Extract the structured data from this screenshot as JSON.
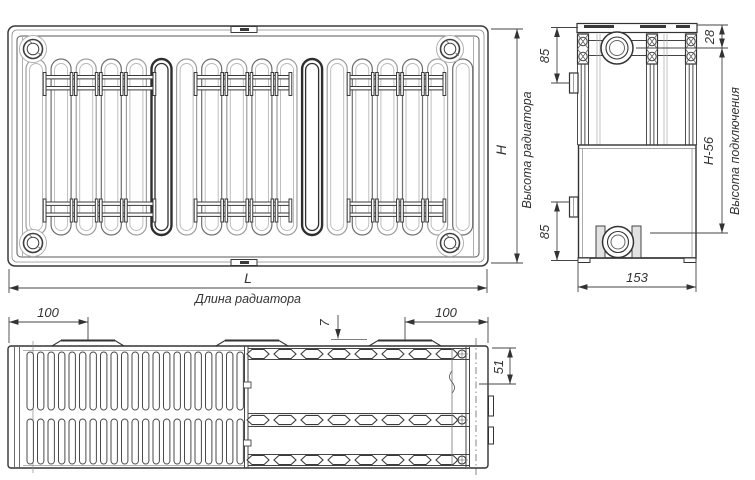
{
  "front_view": {
    "height_symbol": "H",
    "height_caption": "Высота радиатора",
    "length_symbol": "L",
    "length_caption": "Длина радиатора"
  },
  "side_view": {
    "top_bracket_offset": "85",
    "bottom_bracket_offset": "85",
    "top_edge_to_axis": "28",
    "connection_span": "H-56",
    "connection_caption": "Высота подключения",
    "depth": "153"
  },
  "top_view": {
    "left_bracket_offset": "100",
    "right_bracket_offset": "100",
    "grille_step": "7",
    "panel_depth": "51"
  },
  "colors": {
    "line": "#3a3a3a",
    "light_line": "#9a9a9a",
    "dim_line": "#444444",
    "background": "#ffffff"
  }
}
